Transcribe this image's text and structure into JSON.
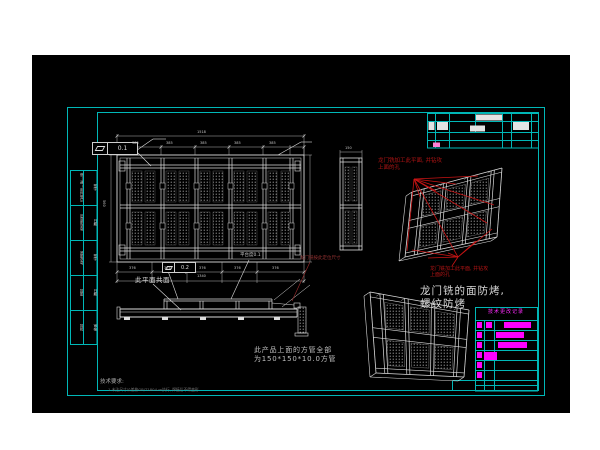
{
  "page": {
    "background": "#ffffff",
    "canvas_background": "#000000"
  },
  "colors": {
    "frame_cyan": "#00b7b7",
    "linework_white": "#dcdcdc",
    "annotation_red": "#b41414",
    "leader_red": "#c81414",
    "table_magenta": "#ff00ff",
    "dim_gray": "#c8c8c8"
  },
  "fcf_top": {
    "symbol_icon": "flatness",
    "value": "0.1"
  },
  "fcf_mid": {
    "symbol_icon": "flatness",
    "value": "0.2"
  },
  "notes": {
    "coplanar": "此平面共面",
    "platform": "平台度0.1",
    "gantry_locate": "龙门铣按此定位尺寸",
    "red_top_1": "龙门铣加工此平面, 并钻攻",
    "red_top_2": "上面的孔",
    "red_mid_1": "龙门铣加工此平面, 并钻攻",
    "red_mid_2": "上面的孔",
    "antibake_1": "龙门铣的面防烤,",
    "antibake_2": "螺纹防烤",
    "tube_1": "此产品上面的方管全部",
    "tube_2": "为150*150*10.0方管",
    "tech_title": "技术要求:",
    "tech_item": "1.未注尺寸公差按GB/T1804-m执行, 焊接后不得变形"
  },
  "dims": {
    "overall_top": "1518",
    "seg_top": "385",
    "overall_bottom": "1340",
    "seg_bottom": "376",
    "left_height": "560",
    "end_width": "150"
  },
  "margin_strip": {
    "rows": [
      [
        "借(通)用件登记",
        "签字"
      ],
      [
        "旧底图总号",
        "日期"
      ],
      [
        "底图总号",
        "签字"
      ],
      [
        "描图",
        "日期"
      ],
      [
        "描校",
        "审核"
      ]
    ]
  },
  "parts_table": {
    "title": "技术更改记录",
    "rows": [
      {
        "m1": true,
        "m2": true,
        "bar_x": 29,
        "bar_w": 27
      },
      {
        "m1": true,
        "m2": false,
        "bar_x": 21,
        "bar_w": 28
      },
      {
        "m1": true,
        "m2": false,
        "bar_x": 23,
        "bar_w": 29
      },
      {
        "m1": true,
        "m2": false,
        "bar_x": 9,
        "bar_w": 13
      },
      {
        "m1": true,
        "m2": false
      },
      {
        "m1": true,
        "m2": false
      },
      {}
    ]
  }
}
